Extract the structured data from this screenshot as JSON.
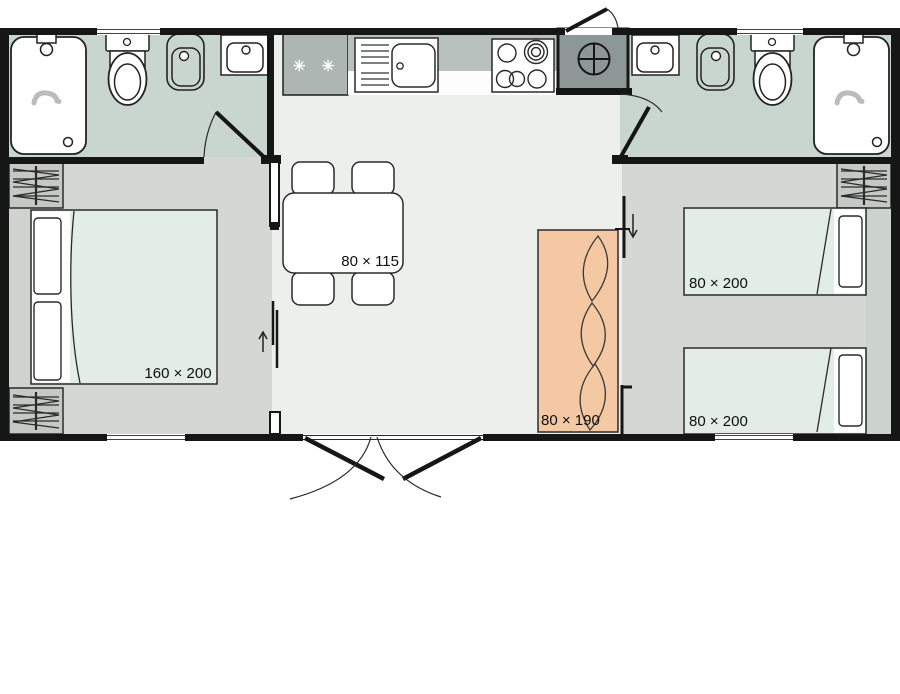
{
  "labels": {
    "master_bed": "160 × 200",
    "dining_table": "80 × 115",
    "sofa": "80 × 190",
    "single_bed_top": "80 × 200",
    "single_bed_bottom": "80 × 200",
    "freezer": "✳ ✳ ✳"
  },
  "icons": {
    "water_heater": "circle-plus",
    "master_bedroom_sliding_door": "arrow-up",
    "twin_bedroom_sliding_door": "arrow-down",
    "wardrobe": "zigzag-hatch"
  },
  "colors": {
    "wall": "#161616",
    "bathroom_floor": "#c9d6d0",
    "bedroom_floor": "#d5d7d4",
    "living_floor": "#edefec",
    "mattress": "#e3ede8",
    "sofa": "#f4c8a3",
    "utility_closet": "#8d9795",
    "fridge": "#adb6b3",
    "counter_top": "#b8c1be",
    "wardrobe": "#c5c9c6",
    "outline": "#2a2a2a"
  }
}
